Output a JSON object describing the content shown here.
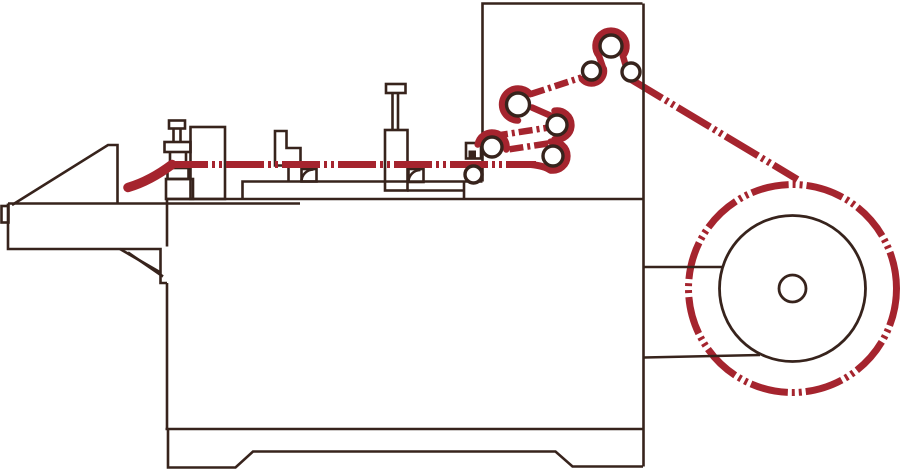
{
  "canvas": {
    "width": 900,
    "height": 470,
    "background": "#ffffff"
  },
  "colors": {
    "outline": "#37231c",
    "web_path": "#a5242e",
    "roller_fill": "#ffffff"
  },
  "diagram": {
    "type": "machine-schematic",
    "parts": [
      "infeed-tray",
      "machine-body",
      "machine-base",
      "entry-guide-bracket",
      "component-box",
      "step-bracket",
      "guide-shoes",
      "screw-jack",
      "clamp-box",
      "idler-roller",
      "festoon-rollers",
      "turner-roller-cluster",
      "unwind-frame",
      "material-roll",
      "web-path"
    ]
  }
}
